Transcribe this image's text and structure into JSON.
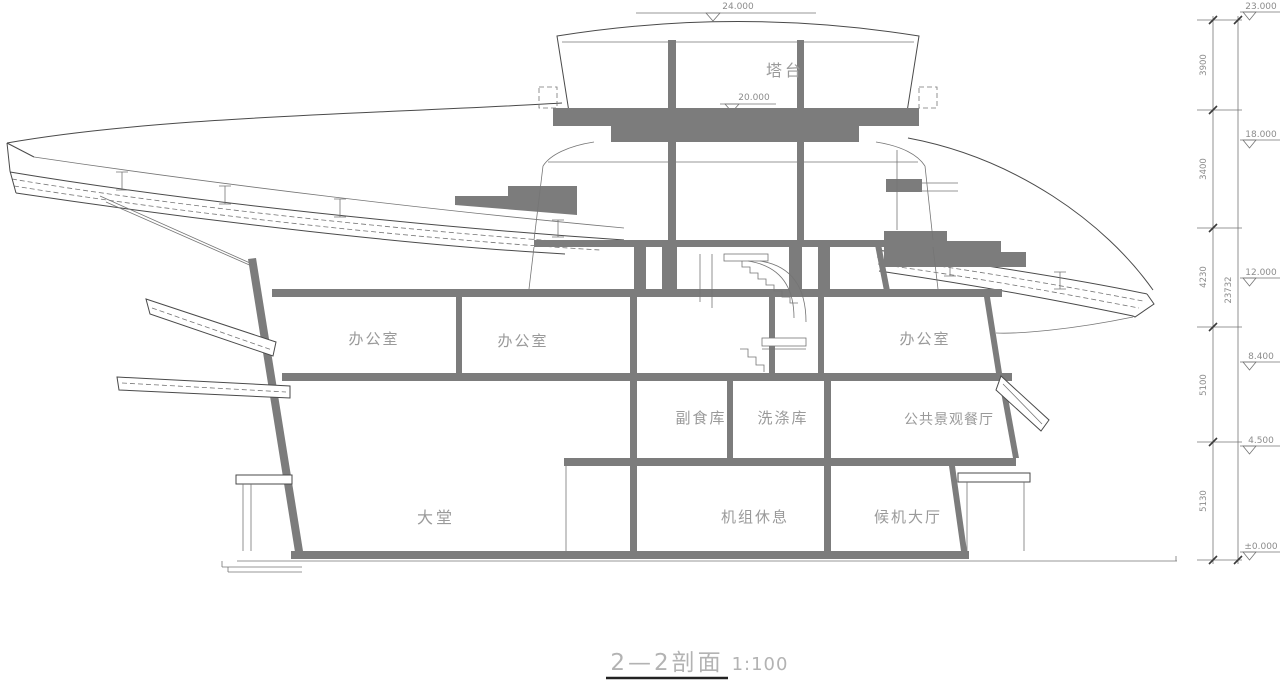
{
  "drawing": {
    "title": "2—2剖面",
    "scale": "1:100"
  },
  "rooms": {
    "tower": "塔台",
    "office_left": "办公室",
    "office_center": "办公室",
    "office_right": "办公室",
    "food_store": "副食库",
    "laundry_store": "洗涤库",
    "restaurant": "公共景观餐厅",
    "lobby": "大堂",
    "crew_rest": "机组休息",
    "waiting_hall": "候机大厅"
  },
  "elevations": {
    "top": "24.000",
    "tower_floor": "20.000",
    "right": [
      "23.000",
      "18.000",
      "12.000",
      "8.400",
      "4.500",
      "±0.000"
    ]
  },
  "dimension_chain": {
    "segments": [
      "3900",
      "3400",
      "4230",
      "5100",
      "5130"
    ],
    "total": "23732"
  },
  "colors": {
    "line": "#4a4a4a",
    "line_light": "#757575",
    "cut_fill": "#7c7c7c",
    "label_text": "#9a9a9a",
    "annotation_text": "#8c8c8c",
    "title_text": "#b3b3b3"
  }
}
